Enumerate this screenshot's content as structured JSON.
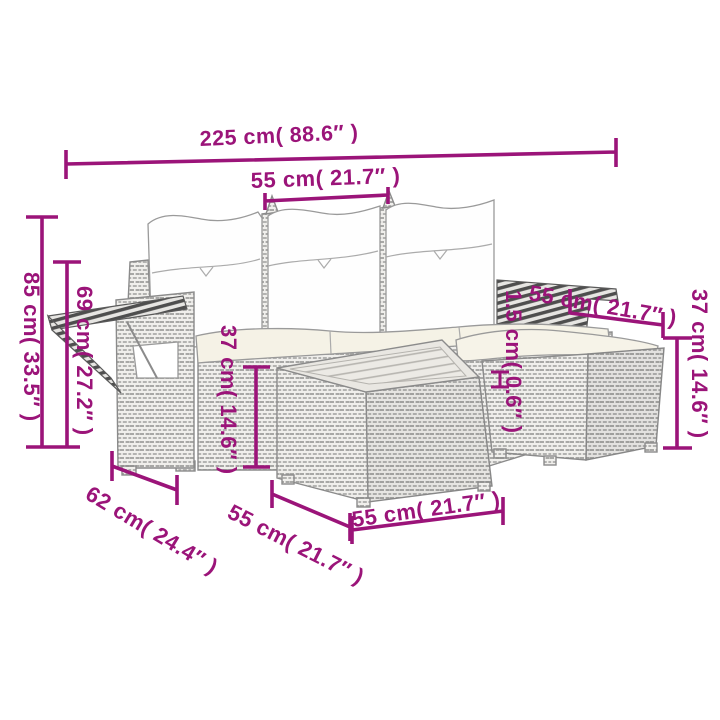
{
  "diagram": {
    "subject": "5-piece poly rattan garden lounge set with cushions (sofa, footstool, coffee table) dimension drawing",
    "colors": {
      "dimension_magenta": "#9B1479",
      "drawing_gray": "#8B8B8B",
      "cushion_white": "#FEFEFE",
      "seat_cream": "#F5F2E6"
    },
    "dimensions": {
      "overall_width": "225 cm( 88.6″ )",
      "seat_width": "55 cm( 21.7″ )",
      "overall_height": "85 cm( 33.5″ )",
      "backrest_folded_height": "69 cm( 27.2″ )",
      "stool_width": "55 cm( 21.7″ )",
      "stool_height": "37 cm( 14.6″ )",
      "frame_gap": "1.5 cm( 0.6″ )",
      "table_height": "37 cm( 14.6″ )",
      "armrest_depth": "62 cm( 24.4″ )",
      "seat_depth": "55 cm( 21.7″ )",
      "table_width": "55 cm( 21.7″ )"
    }
  }
}
